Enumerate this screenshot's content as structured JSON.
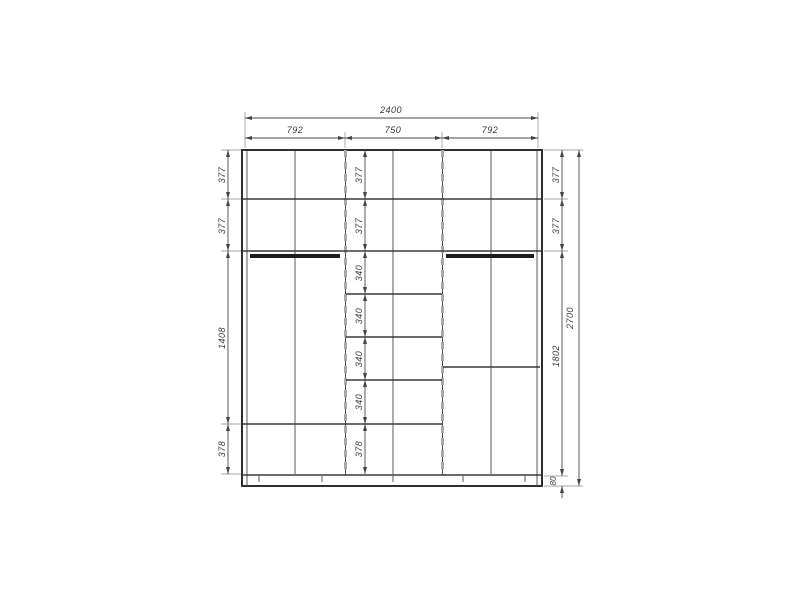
{
  "drawing": {
    "colors": {
      "background": "#ffffff",
      "structure_line": "#3a3a3a",
      "panel_dashed": "#a8a8a8",
      "dimension_line": "#4a4a4a",
      "label_text": "#3a3a3a"
    },
    "dimensions": {
      "top": {
        "overall": "2400",
        "sections": [
          "792",
          "750",
          "792"
        ]
      },
      "left_column": [
        "377",
        "377",
        "1408",
        "378"
      ],
      "center_column": [
        "377",
        "377",
        "340",
        "340",
        "340",
        "340",
        "378"
      ],
      "right_column": [
        "377",
        "377",
        "1802",
        "80"
      ],
      "right_overall": "2700"
    }
  }
}
